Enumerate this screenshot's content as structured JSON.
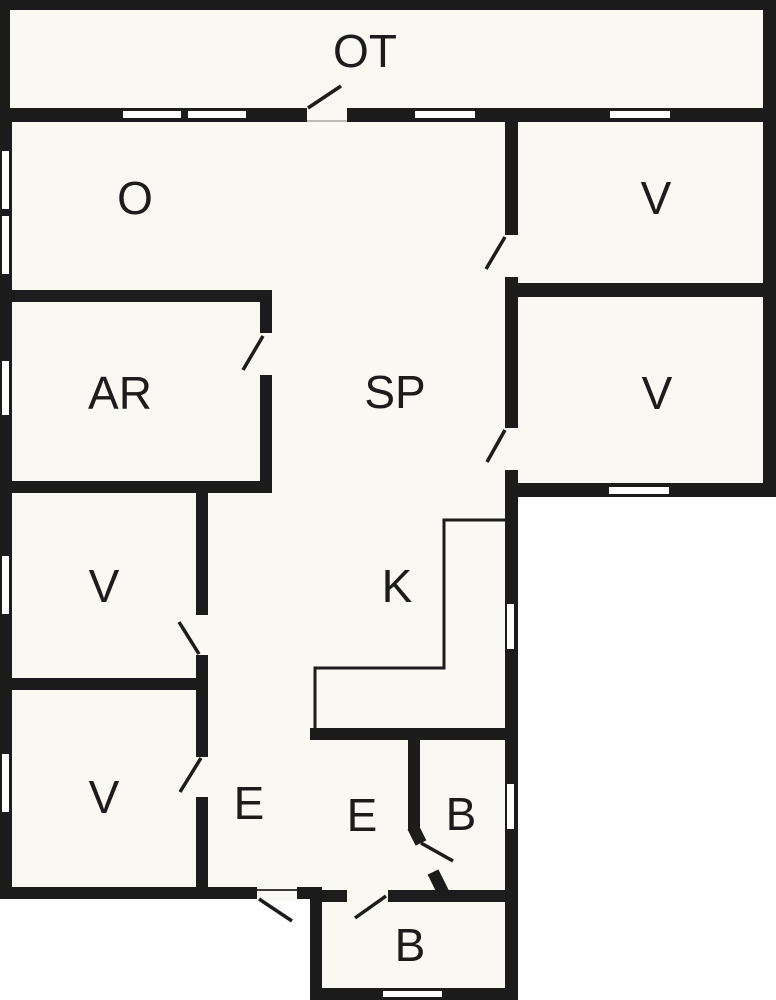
{
  "plan_type": "floor-plan",
  "colors": {
    "wall": "#1c1c1c",
    "floor": "#faf8f2",
    "outside": "#ffffff",
    "window_fill": "#ffffff"
  },
  "rooms": {
    "ot": {
      "label": "OT"
    },
    "o": {
      "label": "O"
    },
    "v1": {
      "label": "V"
    },
    "ar": {
      "label": "AR"
    },
    "sp": {
      "label": "SP"
    },
    "v2": {
      "label": "V"
    },
    "v3": {
      "label": "V"
    },
    "k": {
      "label": "K"
    },
    "v4": {
      "label": "V"
    },
    "e1": {
      "label": "E"
    },
    "e2": {
      "label": "E"
    },
    "b1": {
      "label": "B"
    },
    "b2": {
      "label": "B"
    }
  }
}
